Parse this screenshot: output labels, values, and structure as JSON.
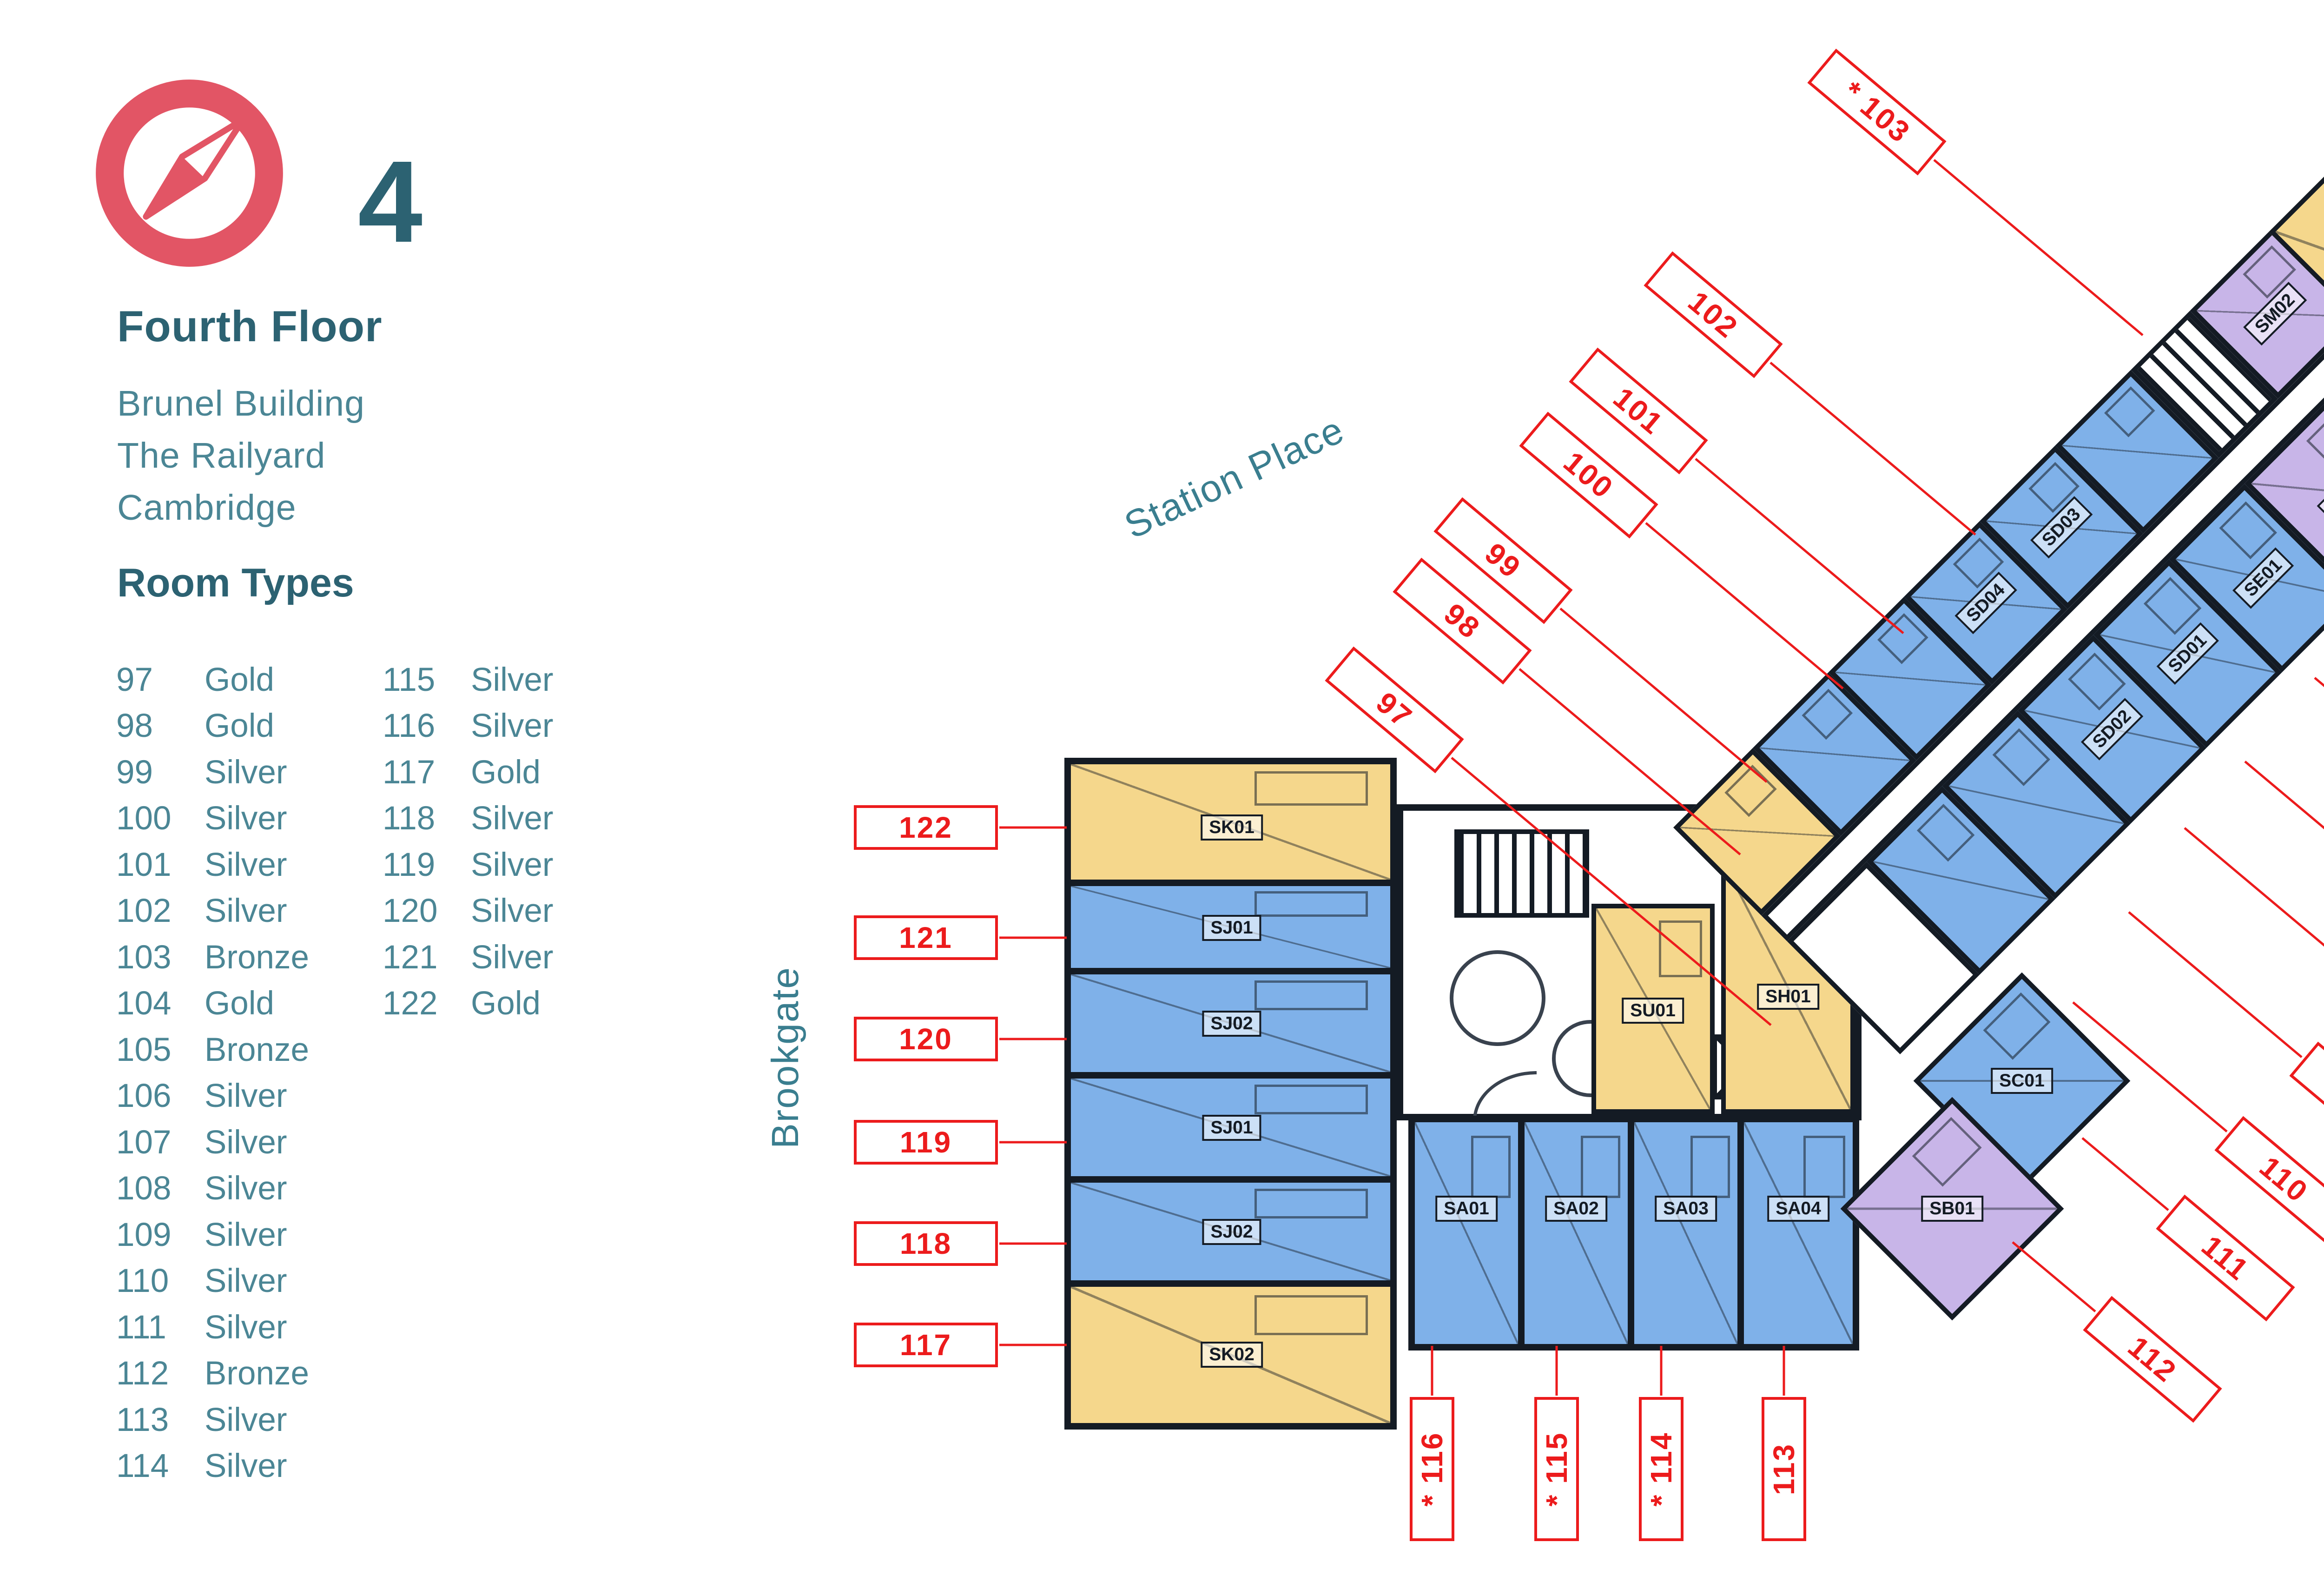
{
  "header": {
    "floor_number": "4",
    "floor_title": "Fourth Floor",
    "address_lines": [
      "Brunel Building",
      "The Railyard",
      "Cambridge"
    ],
    "legend_title": "Room Types"
  },
  "room_types": [
    {
      "room": "97",
      "type": "Gold"
    },
    {
      "room": "98",
      "type": "Gold"
    },
    {
      "room": "99",
      "type": "Silver"
    },
    {
      "room": "100",
      "type": "Silver"
    },
    {
      "room": "101",
      "type": "Silver"
    },
    {
      "room": "102",
      "type": "Silver"
    },
    {
      "room": "103",
      "type": "Bronze"
    },
    {
      "room": "104",
      "type": "Gold"
    },
    {
      "room": "105",
      "type": "Bronze"
    },
    {
      "room": "106",
      "type": "Silver"
    },
    {
      "room": "107",
      "type": "Silver"
    },
    {
      "room": "108",
      "type": "Silver"
    },
    {
      "room": "109",
      "type": "Silver"
    },
    {
      "room": "110",
      "type": "Silver"
    },
    {
      "room": "111",
      "type": "Silver"
    },
    {
      "room": "112",
      "type": "Bronze"
    },
    {
      "room": "113",
      "type": "Silver"
    },
    {
      "room": "114",
      "type": "Silver"
    },
    {
      "room": "115",
      "type": "Silver"
    },
    {
      "room": "116",
      "type": "Silver"
    },
    {
      "room": "117",
      "type": "Gold"
    },
    {
      "room": "118",
      "type": "Silver"
    },
    {
      "room": "119",
      "type": "Silver"
    },
    {
      "room": "120",
      "type": "Silver"
    },
    {
      "room": "121",
      "type": "Silver"
    },
    {
      "room": "122",
      "type": "Gold"
    }
  ],
  "streets": {
    "station_place": "Station Place",
    "brookgate": "Brookgate"
  },
  "colors": {
    "silver_room": "#7FB1E9",
    "gold_room": "#F5D78C",
    "bronze_room": "#C8B5E8",
    "callout_red": "#EC1B1C",
    "teal_dark": "#2C6272",
    "teal": "#4B8695",
    "wall": "#141B24",
    "compass_pink": "#E25565"
  },
  "plan_codes": {
    "sk01": "SK01",
    "sj01": "SJ01",
    "sj02": "SJ02",
    "sk02": "SK02",
    "sa01": "SA01",
    "sa02": "SA02",
    "sa03": "SA03",
    "sa04": "SA04",
    "sb01": "SB01",
    "sc01": "SC01",
    "sd01": "SD01",
    "sd02": "SD02",
    "sd03": "SD03",
    "sd04": "SD04",
    "se01": "SE01",
    "sm01": "SM01",
    "sm02": "SM02",
    "sl01": "SL01",
    "su01": "SU01",
    "sh01": "SH01"
  },
  "callouts": [
    {
      "text": "97"
    },
    {
      "text": "98"
    },
    {
      "text": "99"
    },
    {
      "text": "100"
    },
    {
      "text": "101"
    },
    {
      "text": "102"
    },
    {
      "text": "* 103"
    },
    {
      "text": "104 *"
    },
    {
      "text": "105 *"
    },
    {
      "text": "106"
    },
    {
      "text": "107"
    },
    {
      "text": "108"
    },
    {
      "text": "109"
    },
    {
      "text": "110"
    },
    {
      "text": "111"
    },
    {
      "text": "112"
    },
    {
      "text": "113"
    },
    {
      "text": "* 114"
    },
    {
      "text": "* 115"
    },
    {
      "text": "* 116"
    },
    {
      "text": "117"
    },
    {
      "text": "118"
    },
    {
      "text": "119"
    },
    {
      "text": "120"
    },
    {
      "text": "121"
    },
    {
      "text": "122"
    }
  ]
}
